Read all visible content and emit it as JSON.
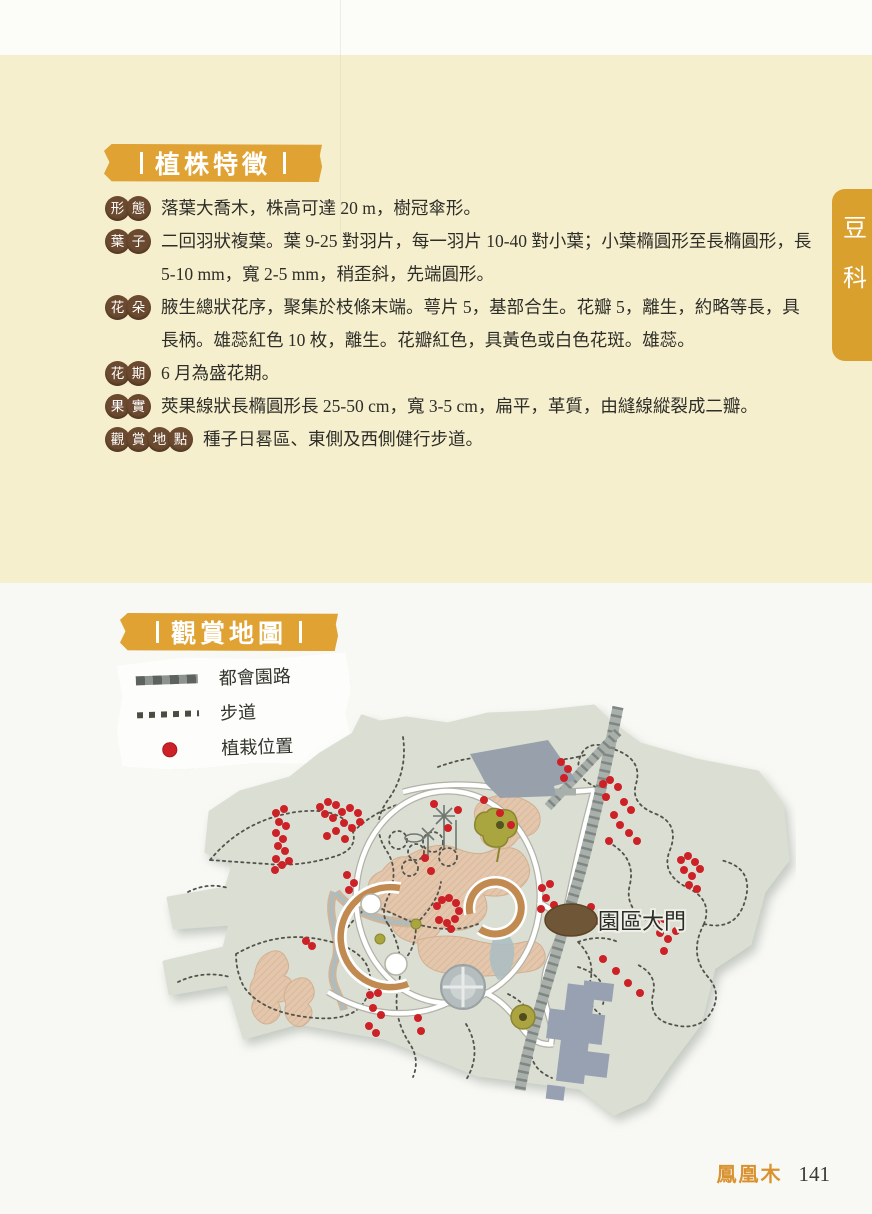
{
  "page": {
    "family_tab": "豆科",
    "footer": {
      "title": "鳳凰木",
      "page_number": "141"
    }
  },
  "sections": {
    "traits": {
      "title": "植株特徵",
      "features": [
        {
          "badge": "形態",
          "text": "落葉大喬木，株高可達 20 m，樹冠傘形。"
        },
        {
          "badge": "葉子",
          "text": "二回羽狀複葉。葉 9-25 對羽片，每一羽片 10-40 對小葉；小葉橢圓形至長橢圓形，長 5-10 mm，寬 2-5 mm，稍歪斜，先端圓形。"
        },
        {
          "badge": "花朵",
          "text": "腋生總狀花序，聚集於枝條末端。萼片 5，基部合生。花瓣 5，離生，約略等長，具長柄。雄蕊紅色 10 枚，離生。花瓣紅色，具黃色或白色花斑。雄蕊。"
        },
        {
          "badge": "花期",
          "text": "6 月為盛花期。"
        },
        {
          "badge": "果實",
          "text": "莢果線狀長橢圓形長 25-50 cm，寬 3-5 cm，扁平，革質，由縫線縱裂成二瓣。"
        },
        {
          "badge": "觀賞地點",
          "text": "種子日晷區、東側及西側健行步道。"
        }
      ]
    },
    "map": {
      "title": "觀賞地圖",
      "legend": [
        {
          "type": "road",
          "label": "都會園路"
        },
        {
          "type": "trail",
          "label": "步道"
        },
        {
          "type": "dot",
          "label": "植栽位置"
        }
      ],
      "gate_label": "園區大門",
      "colors": {
        "plant_dot": "#cc2127",
        "road": "#8d948f",
        "land": "#dbded2",
        "accent": "#dfa233"
      },
      "plant_dots": [
        [
          128,
          121
        ],
        [
          136,
          117
        ],
        [
          131,
          130
        ],
        [
          138,
          134
        ],
        [
          128,
          141
        ],
        [
          135,
          147
        ],
        [
          130,
          154
        ],
        [
          137,
          159
        ],
        [
          128,
          167
        ],
        [
          134,
          173
        ],
        [
          141,
          169
        ],
        [
          127,
          178
        ],
        [
          172,
          115
        ],
        [
          180,
          110
        ],
        [
          188,
          113
        ],
        [
          177,
          122
        ],
        [
          185,
          126
        ],
        [
          194,
          120
        ],
        [
          202,
          116
        ],
        [
          210,
          121
        ],
        [
          196,
          131
        ],
        [
          204,
          136
        ],
        [
          188,
          139
        ],
        [
          212,
          130
        ],
        [
          179,
          144
        ],
        [
          197,
          147
        ],
        [
          199,
          183
        ],
        [
          206,
          191
        ],
        [
          201,
          198
        ],
        [
          289,
          214
        ],
        [
          294,
          208
        ],
        [
          301,
          206
        ],
        [
          308,
          211
        ],
        [
          311,
          219
        ],
        [
          307,
          227
        ],
        [
          299,
          231
        ],
        [
          291,
          228
        ],
        [
          303,
          237
        ],
        [
          455,
          92
        ],
        [
          462,
          88
        ],
        [
          470,
          95
        ],
        [
          458,
          105
        ],
        [
          476,
          110
        ],
        [
          483,
          118
        ],
        [
          466,
          123
        ],
        [
          472,
          133
        ],
        [
          481,
          141
        ],
        [
          489,
          149
        ],
        [
          461,
          149
        ],
        [
          413,
          70
        ],
        [
          420,
          77
        ],
        [
          416,
          86
        ],
        [
          533,
          168
        ],
        [
          540,
          164
        ],
        [
          547,
          170
        ],
        [
          536,
          178
        ],
        [
          544,
          184
        ],
        [
          552,
          177
        ],
        [
          541,
          193
        ],
        [
          549,
          197
        ],
        [
          508,
          231
        ],
        [
          516,
          227
        ],
        [
          512,
          241
        ],
        [
          520,
          247
        ],
        [
          528,
          239
        ],
        [
          516,
          259
        ],
        [
          394,
          196
        ],
        [
          402,
          192
        ],
        [
          398,
          206
        ],
        [
          406,
          213
        ],
        [
          393,
          217
        ],
        [
          222,
          303
        ],
        [
          230,
          301
        ],
        [
          225,
          316
        ],
        [
          233,
          323
        ],
        [
          221,
          334
        ],
        [
          228,
          341
        ],
        [
          270,
          326
        ],
        [
          273,
          339
        ],
        [
          286,
          112
        ],
        [
          310,
          118
        ],
        [
          336,
          108
        ],
        [
          352,
          121
        ],
        [
          363,
          133
        ],
        [
          300,
          136
        ],
        [
          455,
          267
        ],
        [
          468,
          279
        ],
        [
          480,
          291
        ],
        [
          492,
          301
        ],
        [
          158,
          249
        ],
        [
          164,
          254
        ],
        [
          277,
          166
        ],
        [
          283,
          179
        ],
        [
          443,
          215
        ],
        [
          448,
          229
        ]
      ]
    }
  }
}
